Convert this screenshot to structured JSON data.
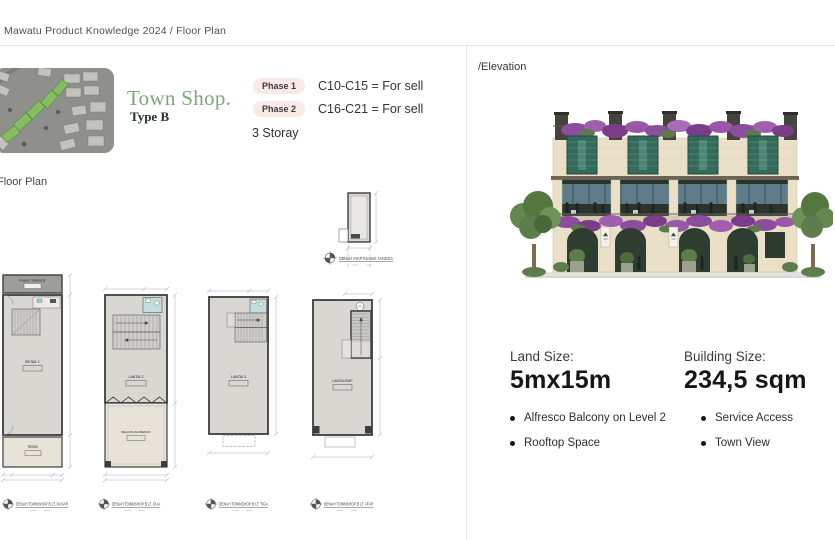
{
  "breadcrumb": "Mawatu Product Knowledge 2024 / Floor Plan",
  "header": {
    "title": "Town Shop.",
    "subtitle": "Type B",
    "phases": [
      {
        "badge": "Phase 1",
        "text": "C10-C15 = For sell"
      },
      {
        "badge": "Phase 2",
        "text": "C16-C21 = For sell"
      }
    ],
    "storey": "3 Storay"
  },
  "floor_plan": {
    "section_label": "Floor Plan",
    "stair_roof_caption": "DENAH ATAP RUANG TANGGA",
    "plans": [
      {
        "caption": "DENAH TOWNSHOP B LT. DASAR",
        "rooms": [
          "PUBLIC TERRACE",
          "RETAIL 1",
          "TERAS"
        ]
      },
      {
        "caption": "DENAH TOWNSHOP B LT. DUA",
        "rooms": [
          "LANTAI 2",
          "BALKON ALFRESCO"
        ]
      },
      {
        "caption": "DENAH TOWNSHOP B LT. TIGA",
        "rooms": [
          "LANTAI 3"
        ]
      },
      {
        "caption": "DENAH TOWNSHOP B LT. ATAP",
        "rooms": [
          "LANTAI ATAP"
        ]
      }
    ]
  },
  "elevation": {
    "section_label": "/Elevation",
    "land_size_label": "Land Size:",
    "land_size_value": "5mx15m",
    "building_size_label": "Building Size:",
    "building_size_value": "234,5 sqm",
    "features_col1": [
      "Alfresco Balcony on Level 2",
      "Rooftop Space"
    ],
    "features_col2": [
      "Service Access",
      "Town View"
    ]
  },
  "colors": {
    "accent_green": "#7CA878",
    "badge_pink": "#FAEAE7",
    "divider": "#E6E6E6",
    "plan_wall": "#3D3D3D",
    "plan_floor": "#D8D7D2",
    "plan_terrace": "#E7E3D8",
    "plan_bathroom": "#BFE0DD",
    "map_highlight_green": "#85BD62",
    "facade_beige": "#E9E0C7",
    "window_green": "#35695C",
    "flower_purple": "#8C4D9C"
  }
}
